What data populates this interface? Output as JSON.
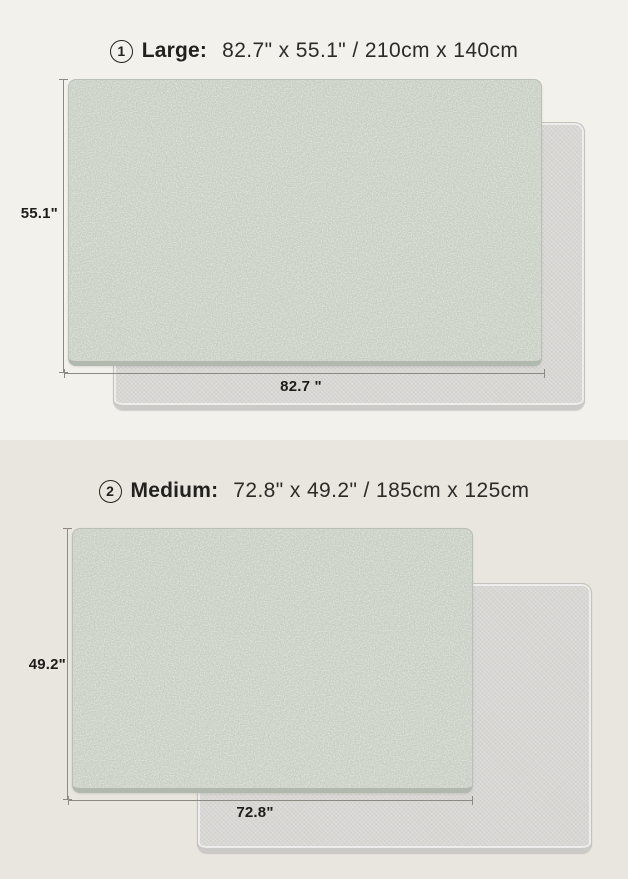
{
  "page": {
    "title": "Play mat size comparison infographic",
    "colors": {
      "panel_top_bg": "#f3f1ec",
      "panel_bottom_bg": "#e9e6df",
      "mat_green": "#ccd2c8",
      "mat_green_edge": "#b1b8ad",
      "mat_gray": "#d7d6d3",
      "text": "#23211e",
      "dimension_line": "#8d8a83"
    }
  },
  "sections": [
    {
      "badge": "1",
      "name": "Large:",
      "size_text": "82.7\" x 55.1\" / 210cm x 140cm",
      "height_label": "55.1\"",
      "width_label": "82.7 \""
    },
    {
      "badge": "2",
      "name": "Medium:",
      "size_text": "72.8\" x 49.2\" / 185cm x 125cm",
      "height_label": "49.2\"",
      "width_label": "72.8\""
    }
  ]
}
